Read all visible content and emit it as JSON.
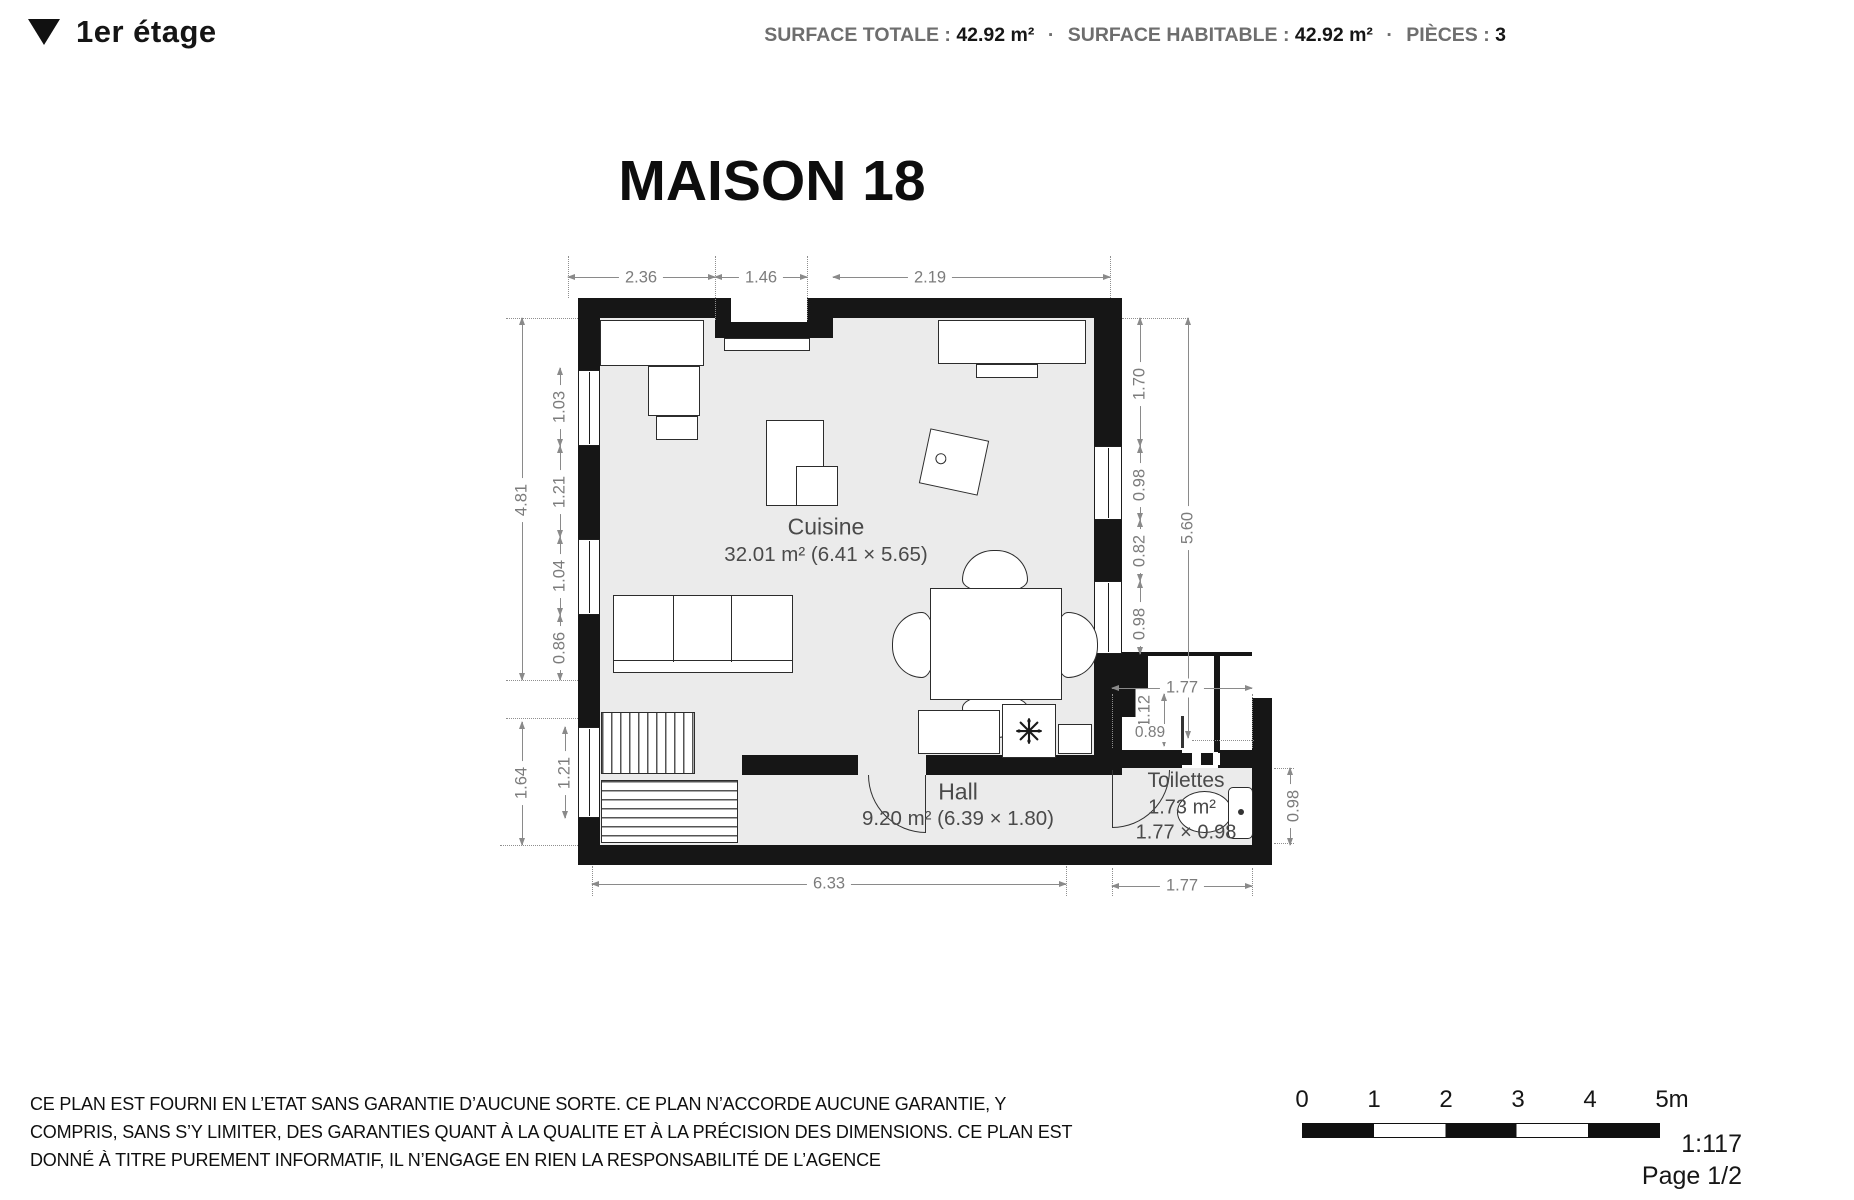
{
  "header": {
    "collapse_icon": "▼",
    "floor_label": "1er étage",
    "separator": "·",
    "stats": [
      {
        "label": "SURFACE TOTALE :",
        "value": "42.92 m²"
      },
      {
        "label": "SURFACE HABITABLE :",
        "value": "42.92 m²"
      },
      {
        "label": "PIÈCES :",
        "value": "3"
      }
    ]
  },
  "plan": {
    "title": "MAISON 18",
    "rooms": {
      "cuisine": {
        "name": "Cuisine",
        "area": "32.01 m² (6.41 × 5.65)"
      },
      "hall": {
        "name": "Hall",
        "area": "9.20 m² (6.39 × 1.80)"
      },
      "toilettes": {
        "name": "Toilettes",
        "area": "1.73 m²",
        "size": "1.77 × 0.98"
      }
    },
    "dims": {
      "top": [
        "2.36",
        "1.46",
        "2.19"
      ],
      "left_outer": [
        "4.81",
        "1.64"
      ],
      "left_inner": [
        "1.03",
        "1.21",
        "1.04",
        "0.86"
      ],
      "left_lower_inner": "1.21",
      "right_inner": [
        "1.70",
        "0.98",
        "0.82",
        "0.98"
      ],
      "right_outer": "5.60",
      "nook": {
        "top": "1.77",
        "height": "1.12",
        "width": "0.89",
        "right": "0.98"
      },
      "bottom": [
        "6.33",
        "1.77"
      ]
    }
  },
  "footer": {
    "disclaimer_lines": [
      "CE PLAN EST FOURNI EN L’ETAT SANS GARANTIE D’AUCUNE SORTE. CE PLAN N’ACCORDE AUCUNE GARANTIE, Y",
      "COMPRIS, SANS S’Y LIMITER, DES GARANTIES QUANT À LA QUALITE ET À LA PRÉCISION DES DIMENSIONS. CE PLAN EST",
      "DONNÉ À TITRE PUREMENT INFORMATIF, IL N’ENGAGE EN RIEN LA RESPONSABILITÉ DE L’AGENCE"
    ],
    "scale_ticks": [
      "0",
      "1",
      "2",
      "3",
      "4",
      "5m"
    ],
    "scale_ratio": "1:117",
    "page": "Page 1/2"
  },
  "colors": {
    "wall": "#161616",
    "floor": "#ebebeb",
    "dim_gray": "#7c7c7c",
    "text_black": "#161616"
  }
}
